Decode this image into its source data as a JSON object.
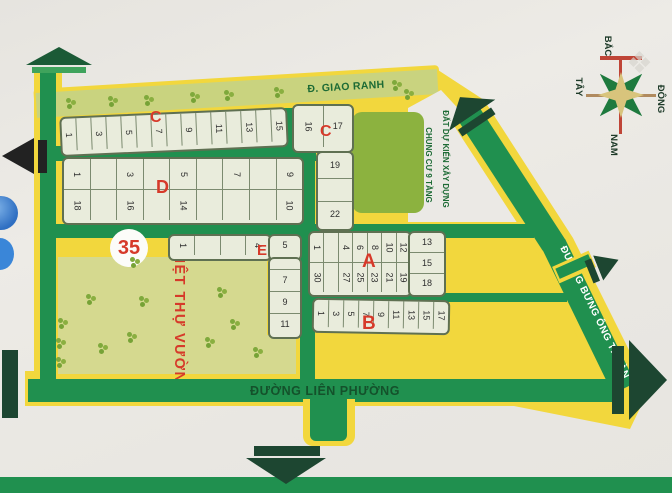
{
  "colors": {
    "land": "#f2d73d",
    "road": "#20904f",
    "road_light": "#c9d37f",
    "park": "#8cb23f",
    "garden": "#d5d98f",
    "red": "#d63a2a",
    "text_green": "#1d6b35",
    "lp_text": "#14512b",
    "arrow": "#1d4631"
  },
  "roads": {
    "giao_ranh": "Đ. GIAO RANH",
    "lien_phuong": "ĐƯỜNG LIÊN PHƯỜNG",
    "bung_ong_thoan": "ĐƯỜNG BƯNG ÔNG THOÀN"
  },
  "notes": {
    "construction_line1": "ĐẤT DỰ KIẾN XÂY DỰNG",
    "construction_line2": "CHUNG CƯ 9 TẦNG",
    "garden": "BIỆT THỰ VƯỜN",
    "plot_number": "35"
  },
  "compass": {
    "north": "BẮC",
    "east": "ĐÔNG",
    "south": "NAM",
    "west": "TÂY"
  },
  "watermark": {
    "glyph": "❖"
  },
  "section_labels": [
    {
      "text": "C",
      "x": 150,
      "y": 110,
      "size": 16
    },
    {
      "text": "C",
      "x": 320,
      "y": 124,
      "size": 16
    },
    {
      "text": "D",
      "x": 156,
      "y": 178,
      "size": 18
    },
    {
      "text": "E",
      "x": 257,
      "y": 243,
      "size": 15
    },
    {
      "text": "A",
      "x": 362,
      "y": 252,
      "size": 19
    },
    {
      "text": "B",
      "x": 362,
      "y": 314,
      "size": 19
    }
  ],
  "blocks": [
    {
      "name": "section-C-row",
      "x": 60,
      "y": 112,
      "w": 224,
      "h": 36,
      "rot": -2.5,
      "type": "rows",
      "rowH": [
        32
      ],
      "rows": [
        [
          "1",
          "",
          "3",
          "",
          "5",
          "",
          "7",
          "",
          "9",
          "",
          "11",
          "",
          "13",
          "",
          "15"
        ]
      ],
      "numRot": true,
      "upright": []
    },
    {
      "name": "section-C-corner",
      "x": 292,
      "y": 104,
      "w": 58,
      "h": 45,
      "rot": 0,
      "type": "rows",
      "rowH": [
        41
      ],
      "rows": [
        [
          "16",
          "17"
        ]
      ],
      "numRot": true,
      "upright": [
        "17"
      ]
    },
    {
      "name": "section-C-strip",
      "x": 316,
      "y": 151,
      "w": 34,
      "h": 76,
      "rot": 0,
      "type": "col",
      "cells": [
        "19",
        "",
        "22"
      ],
      "cellH": [
        25,
        22,
        25
      ],
      "numRot": false
    },
    {
      "name": "section-D",
      "x": 62,
      "y": 157,
      "w": 238,
      "h": 64,
      "rot": 0,
      "type": "rows",
      "rowH": [
        30,
        30
      ],
      "rows": [
        [
          "1",
          "",
          "3",
          "",
          "5",
          "",
          "7",
          "",
          "9"
        ],
        [
          "18",
          "",
          "16",
          "",
          "14",
          "",
          "",
          "",
          "10"
        ]
      ],
      "numRot": true,
      "upright": []
    },
    {
      "name": "section-A-main",
      "x": 308,
      "y": 231,
      "w": 100,
      "h": 62,
      "rot": 0,
      "type": "rows",
      "rowH": [
        29,
        29
      ],
      "rows": [
        [
          "1",
          "",
          "4",
          "6",
          "8",
          "10",
          "12"
        ],
        [
          "30",
          "",
          "27",
          "25",
          "23",
          "21",
          "19"
        ]
      ],
      "numRot": true,
      "upright": []
    },
    {
      "name": "section-A-right",
      "x": 408,
      "y": 231,
      "w": 34,
      "h": 62,
      "rot": 0,
      "type": "col",
      "cells": [
        "13",
        "15",
        "18"
      ],
      "cellH": [
        19,
        20,
        19
      ],
      "numRot": false
    },
    {
      "name": "section-B",
      "x": 312,
      "y": 299,
      "w": 134,
      "h": 31,
      "rot": 1,
      "type": "rows",
      "rowH": [
        27
      ],
      "rows": [
        [
          "1",
          "3",
          "5",
          "7",
          "9",
          "11",
          "13",
          "15",
          "17"
        ]
      ],
      "numRot": true,
      "upright": []
    },
    {
      "name": "section-E-top",
      "x": 168,
      "y": 234,
      "w": 100,
      "h": 23,
      "rot": 0,
      "type": "rows",
      "rowH": [
        19
      ],
      "rows": [
        [
          "1",
          "",
          "",
          "4"
        ]
      ],
      "numRot": true,
      "upright": []
    },
    {
      "name": "section-E-corner",
      "x": 268,
      "y": 234,
      "w": 30,
      "h": 23,
      "rot": 0,
      "type": "rows",
      "rowH": [
        19
      ],
      "rows": [
        [
          "5"
        ]
      ],
      "numRot": false,
      "upright": []
    },
    {
      "name": "section-E-strip",
      "x": 268,
      "y": 257,
      "w": 30,
      "h": 78,
      "rot": 0,
      "type": "col",
      "cells": [
        "",
        "7",
        "9",
        "11"
      ],
      "cellH": [
        10,
        21,
        21,
        21
      ],
      "numRot": false
    }
  ],
  "trees_road": [
    [
      66,
      98
    ],
    [
      108,
      96
    ],
    [
      144,
      95
    ],
    [
      190,
      92
    ],
    [
      224,
      90
    ],
    [
      274,
      87
    ],
    [
      392,
      80
    ],
    [
      404,
      89
    ]
  ],
  "trees_garden": [
    [
      58,
      318
    ],
    [
      86,
      294
    ],
    [
      130,
      257
    ],
    [
      139,
      296
    ],
    [
      217,
      287
    ],
    [
      230,
      319
    ],
    [
      253,
      347
    ],
    [
      56,
      338
    ],
    [
      98,
      343
    ],
    [
      127,
      332
    ],
    [
      56,
      357
    ],
    [
      205,
      337
    ]
  ]
}
